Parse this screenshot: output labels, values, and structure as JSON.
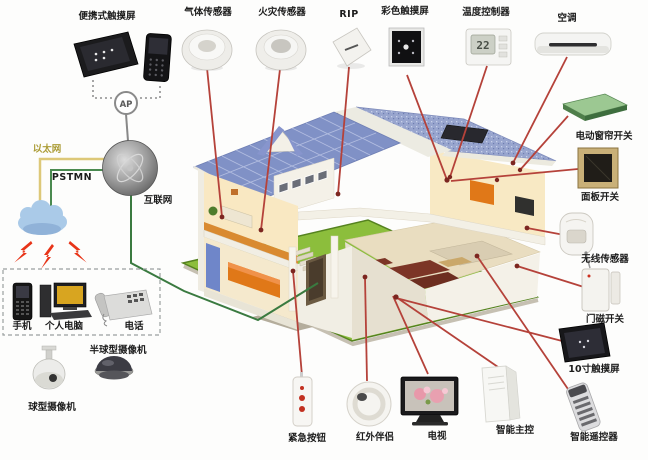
{
  "network": {
    "portable_touchscreen_label": "便携式触摸屏",
    "ap_label": "AP",
    "ethernet_label": "以太网",
    "pstn_label": "PSTMN",
    "internet_label": "互联网"
  },
  "client_box": {
    "mobile_label": "手机",
    "pc_label": "个人电脑",
    "phone_label": "电话"
  },
  "cameras": {
    "dome_label": "半球型摄像机",
    "ptz_label": "球型摄像机"
  },
  "sensors_top": {
    "gas": "气体传感器",
    "fire": "火灾传感器",
    "pir": "RIP",
    "color_touchscreen": "彩色触摸屏",
    "thermostat": "温度控制器",
    "thermostat_reading": "22",
    "ac": "空调"
  },
  "devices_right": {
    "curtain_switch": "电动窗帘开关",
    "panel_switch": "面板开关",
    "wireless_sensor": "无线传感器",
    "door_sensor": "门磁开关",
    "touchscreen_10": "10寸触摸屏",
    "remote": "智能遥控器"
  },
  "devices_bottom": {
    "emergency_button": "紧急按钮",
    "ir_companion": "红外伴侣",
    "tv": "电视",
    "main_controller": "智能主控"
  },
  "colors": {
    "line_red": "#b5423a",
    "line_green": "#3a7a40",
    "line_yellow": "#ddc878",
    "roof_blue": "#8091c6",
    "lawn_green": "#8cbe3c",
    "accent_orange": "#e07818",
    "lightning_red": "#e83418"
  }
}
